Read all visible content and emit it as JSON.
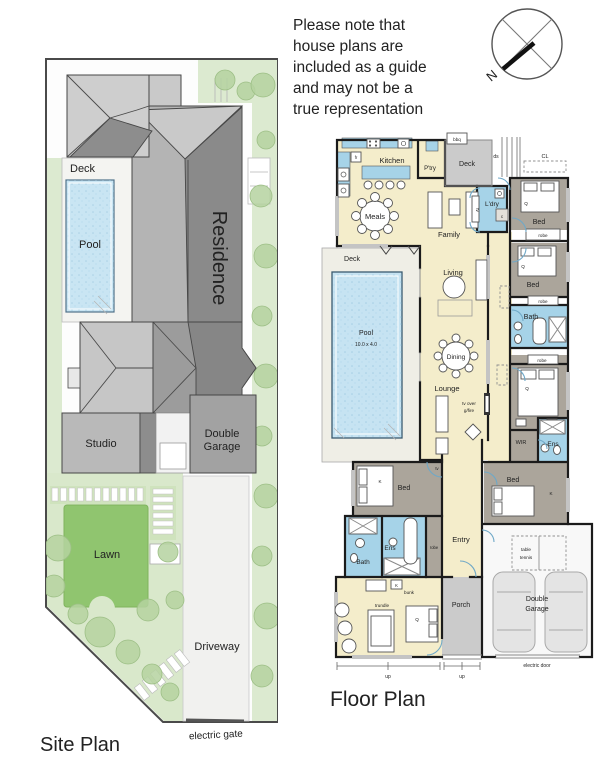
{
  "note_lines": [
    "Please note that",
    "house plans are",
    "included as a guide",
    "and may not be a",
    "true representation"
  ],
  "compass": {
    "north": "N"
  },
  "site_plan": {
    "title": "Site Plan",
    "deck": "Deck",
    "pool": "Pool",
    "residence": "Residence",
    "studio": "Studio",
    "garage_line1": "Double",
    "garage_line2": "Garage",
    "lawn": "Lawn",
    "driveway": "Driveway",
    "electric_gate": "electric gate"
  },
  "floor_plan": {
    "title": "Floor Plan",
    "kitchen": "Kitchen",
    "fridge": "fr",
    "pantry": "P'try",
    "bbq": "bbq",
    "deck": "Deck",
    "steps": "ds",
    "clothesline": "CL",
    "laundry": "L'dry",
    "cupboard": "c",
    "tv": "tv",
    "meals": "Meals",
    "family": "Family",
    "bed": "Bed",
    "robe": "robe",
    "living": "Living",
    "bath": "Bath",
    "dining": "Dining",
    "lounge": "Lounge",
    "tv_over": "tv over",
    "gas_fire": "g/fire",
    "pool": "Pool",
    "pool_size": "10.0 x 4.0",
    "wir": "WIR",
    "ensuite": "Ens",
    "entry": "Entry",
    "king": "K",
    "queen": "Q",
    "bunk": "bunk",
    "trundle": "trundle",
    "table_tennis_line1": "table",
    "table_tennis_line2": "tennis",
    "porch": "Porch",
    "garage_line1": "Double",
    "garage_line2": "Garage",
    "electric_door": "electric door",
    "up": "up"
  }
}
